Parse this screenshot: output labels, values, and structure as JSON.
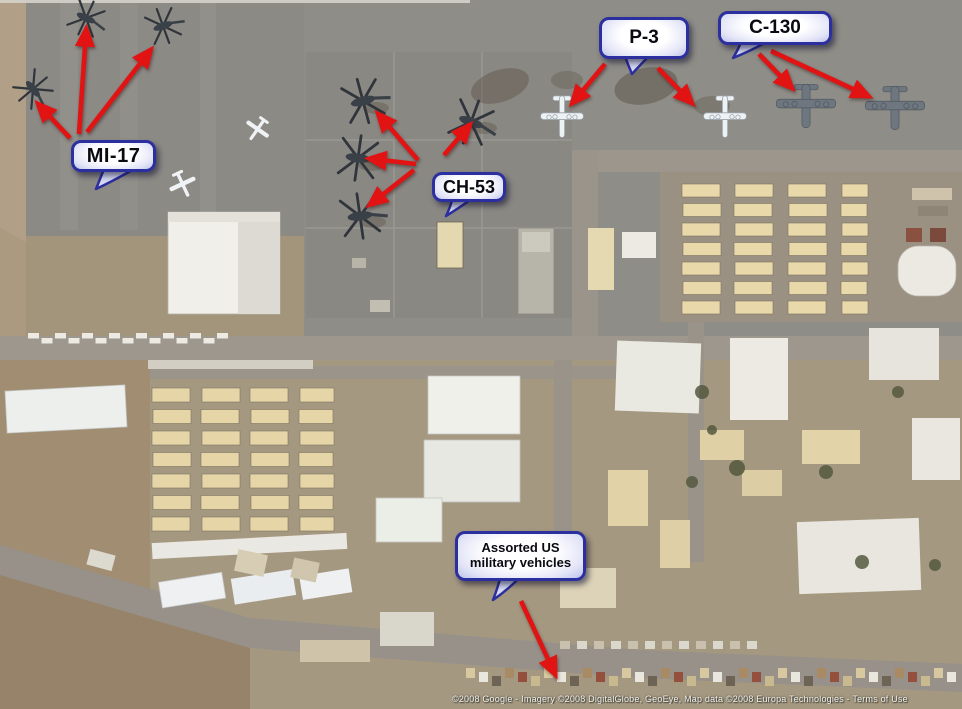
{
  "callouts": {
    "mi17": {
      "label": "MI-17"
    },
    "ch53": {
      "label": "CH-53"
    },
    "p3": {
      "label": "P-3"
    },
    "c130": {
      "label": "C-130"
    },
    "vehicles": {
      "label_line1": "Assorted US",
      "label_line2": "military vehicles"
    }
  },
  "attribution": {
    "text": "©2008 Google - Imagery ©2008 DigitalGlobe, GeoEye, Map data ©2008 Europa Technologies - Terms of Use"
  },
  "colors": {
    "arrow_red": "#e21313",
    "callout_border": "#2c2f9e",
    "callout_fill_center": "#ffffff",
    "callout_fill_edge": "#aeb3e4",
    "tarmac_gray": "#8f8d87",
    "dirt_tan": "#a59880",
    "barracks_tan": "#e9d8aa"
  }
}
